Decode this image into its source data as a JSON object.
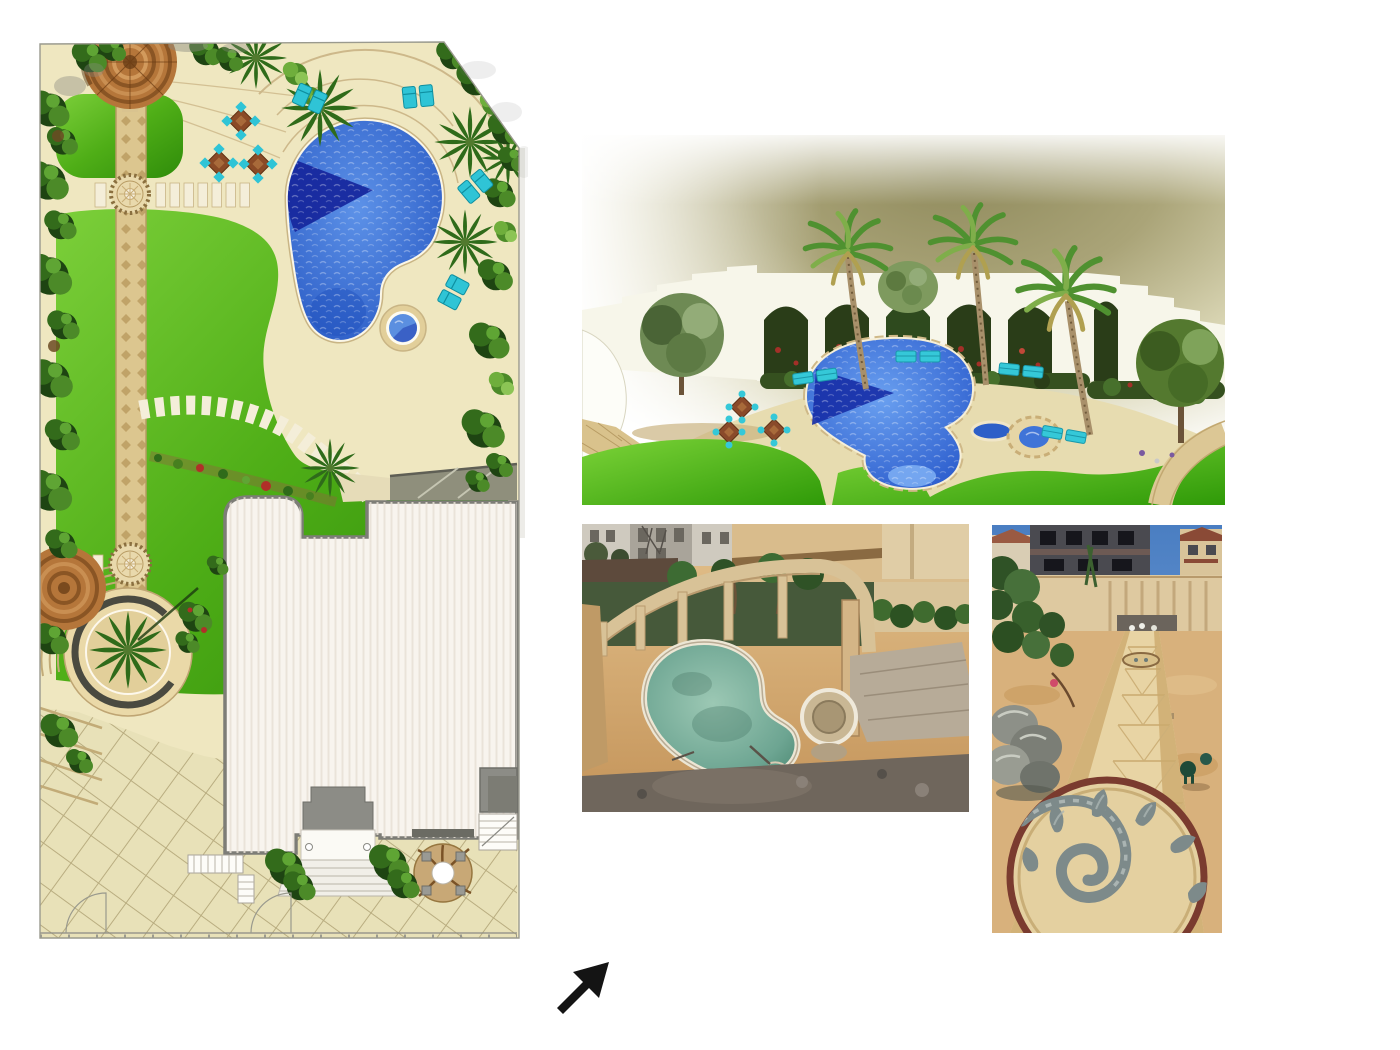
{
  "document": {
    "background_color": "#ffffff",
    "kind": "landscape design presentation sheet"
  },
  "panels": {
    "site_plan": {
      "aria_label": "Top-view garden site plan with freeform swimming pool, spa, lawns, gazebo, pathways, circular palm planter and villa roof",
      "colors": {
        "lawn": "#4fae17",
        "deck": "#efe7c0",
        "pool": "#2d5fc8",
        "pool_shadow": "#17289e",
        "path": "#dcc68f",
        "roof": "#f8f4ee",
        "outline": "#8a8a84",
        "gazebo": "#b5763a",
        "chairs": "#2fc4d6"
      }
    },
    "render_3d": {
      "aria_label": "3D rendering of the pool court with white arched wall, palm trees, lawn and freeform pool",
      "colors": {
        "background": "#a49e70",
        "wall": "#f7f6ea",
        "lawn": "#3aa80e",
        "pool": "#2d5fc8",
        "deck": "#e7dcb0"
      }
    },
    "construction_photo": {
      "aria_label": "Aerial construction photo of the pool shell with arched colonnade wall and sandy site",
      "colors": {
        "sand": "#d3a86b",
        "water": "#6da592",
        "wall": "#dcc79c",
        "rubble": "#6f665c"
      }
    },
    "walkway_photo": {
      "aria_label": "Construction photo of stamped concrete walkway with spiral medallion, rocks and boundary wall",
      "colors": {
        "sky": "#4a7ec2",
        "path": "#e8d4a4",
        "medallion_motif": "#7d8a8a",
        "rim": "#7a3b2f"
      }
    }
  },
  "arrow_icon": {
    "glyph": "northeast-arrow",
    "color": "#141414"
  }
}
